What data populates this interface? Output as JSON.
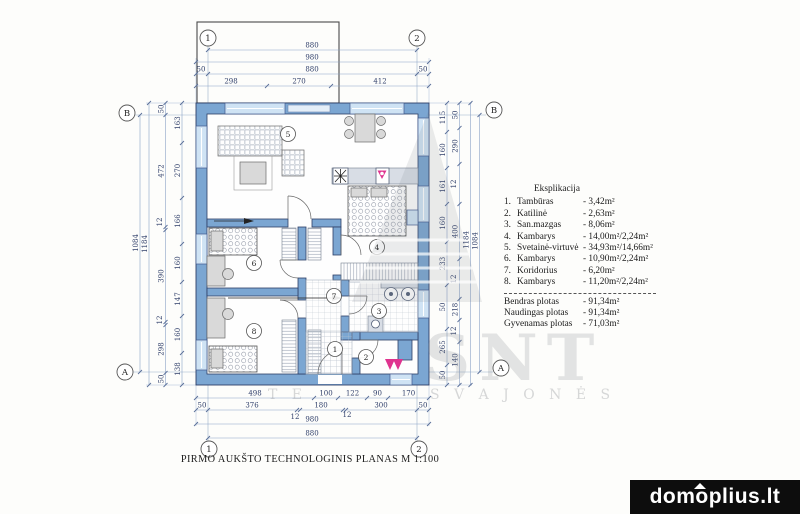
{
  "title": "PIRMO AUKŠTO TECHNOLOGINIS PLANAS M 1:100",
  "watermarks": {
    "brand": "domoplius.lt",
    "big_text": "SNT",
    "tagline": "S V A J O N Ė S",
    "tagline_left": "T E"
  },
  "grid": {
    "c1": "1",
    "c2": "2",
    "rA": "A",
    "rB": "B"
  },
  "rooms": [
    "1",
    "2",
    "3",
    "4",
    "5",
    "6",
    "7",
    "8"
  ],
  "legend": {
    "heading": "Eksplikacija",
    "items": [
      {
        "no": "1.",
        "name": "Tambūras",
        "area": "- 3,42m²"
      },
      {
        "no": "2.",
        "name": "Katilinė",
        "area": "- 2,63m²"
      },
      {
        "no": "3.",
        "name": "San.mazgas",
        "area": "- 8,06m²"
      },
      {
        "no": "4.",
        "name": "Kambarys",
        "area": "- 14,00m²/2,24m²"
      },
      {
        "no": "5.",
        "name": "Svetainė-virtuvė",
        "area": "- 34,93m²/14,66m²"
      },
      {
        "no": "6.",
        "name": "Kambarys",
        "area": "- 10,90m²/2,24m²"
      },
      {
        "no": "7.",
        "name": "Koridorius",
        "area": "- 6,20m²"
      },
      {
        "no": "8.",
        "name": "Kambarys",
        "area": "- 11,20m²/2,24m²"
      }
    ],
    "totals": [
      {
        "name": "Bendras plotas",
        "area": "- 91,34m²"
      },
      {
        "name": "Naudingas plotas",
        "area": "- 91,34m²"
      },
      {
        "name": "Gyvenamas plotas",
        "area": "- 71,03m²"
      }
    ]
  },
  "dims": {
    "top": [
      "880",
      "980",
      "50",
      "880",
      "50",
      "298",
      "270",
      "412"
    ],
    "bottom_row1": [
      "498",
      "100",
      "122",
      "90",
      "170"
    ],
    "bottom_row2": [
      "50",
      "376",
      "180",
      "300",
      "50"
    ],
    "bottom_small": [
      "12",
      "12"
    ],
    "bottom_totals": [
      "980",
      "880"
    ],
    "left_totals": [
      "1084",
      "1184"
    ],
    "left_mid": [
      "50",
      "472",
      "12",
      "390",
      "12",
      "298",
      "50"
    ],
    "left_inner": [
      "163",
      "270",
      "166",
      "160",
      "147",
      "160",
      "138"
    ],
    "right_inner": [
      "115",
      "160",
      "161",
      "160",
      "233",
      "50",
      "265",
      "50"
    ],
    "right_outer": [
      "50",
      "290",
      "12",
      "400",
      "12",
      "218",
      "12",
      "140"
    ],
    "right_totals": [
      "1184",
      "1084"
    ]
  },
  "colors": {
    "wall_blue": "#7ba6d2",
    "window_blue": "#cfe3f4",
    "dim_text": "#31406b",
    "entrance_magenta": "#df338f",
    "badge_bg": "#0d0d0d"
  }
}
